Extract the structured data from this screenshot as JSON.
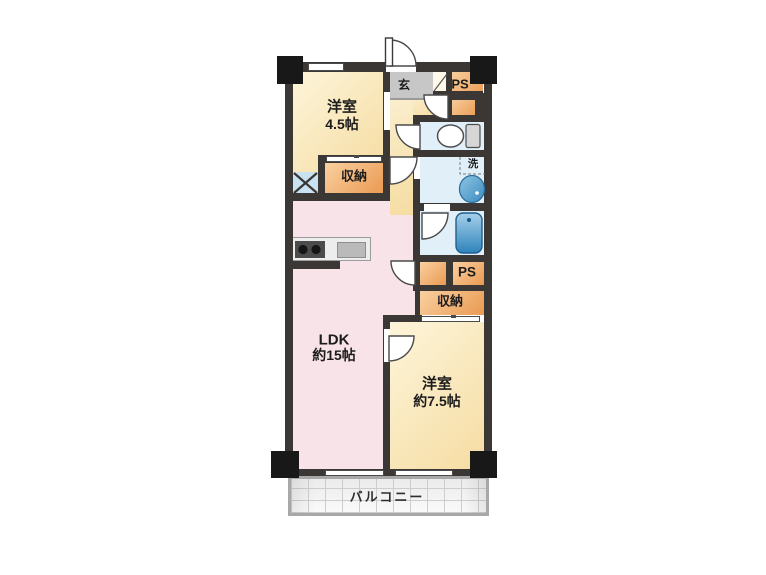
{
  "rooms": {
    "bedroom1": {
      "name": "洋室",
      "size": "4.5帖"
    },
    "ldk": {
      "name": "LDK",
      "size": "約15帖"
    },
    "bedroom2": {
      "name": "洋室",
      "size": "約7.5帖"
    },
    "entrance": {
      "label": "玄"
    },
    "laundry": {
      "label": "洗"
    },
    "ps_top": {
      "label": "PS"
    },
    "ps_middle": {
      "label": "PS"
    },
    "storage_upper": {
      "label": "収納"
    },
    "storage_lower": {
      "label": "収納"
    },
    "balcony": {
      "label": "バルコニー"
    }
  },
  "colors": {
    "wall": "#3b3734",
    "block": "#181818",
    "room_cream_light": "#fdf5da",
    "room_cream_dark": "#f6dca2",
    "orange_light": "#f9d0a0",
    "orange_dark": "#ea9a52",
    "pink": "#f8e4e8",
    "hall_light": "#fbeecd",
    "hall_dark": "#f5dda2",
    "genkan": "#c7c7c7",
    "water_blue": "#e1eff8",
    "shaft_blue": "#c9e2f2",
    "tub_light": "#a6d0ea",
    "tub_dark": "#2e84bc",
    "basin_light": "#8fc5e3",
    "basin_dark": "#3a8cc0"
  }
}
